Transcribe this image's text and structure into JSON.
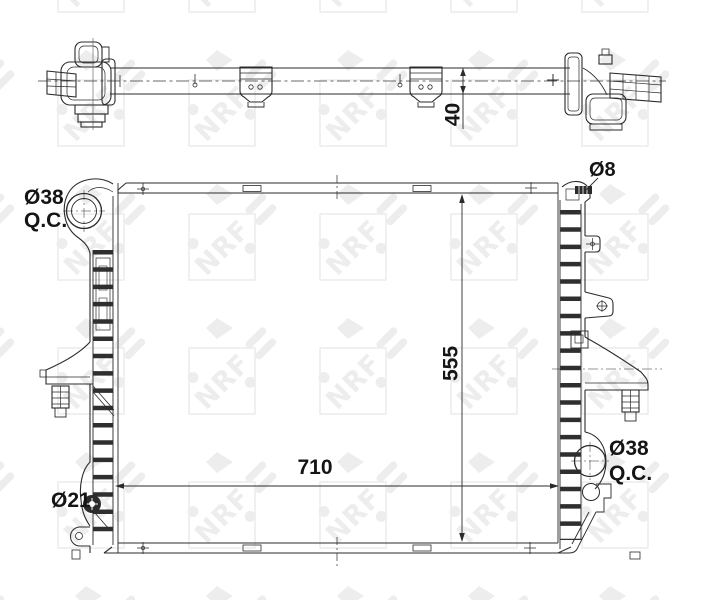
{
  "watermark": {
    "text": "NRF",
    "color": "#ededed"
  },
  "line_color": "#2b2b2b",
  "top_view": {
    "thickness_dimension": "40"
  },
  "front_view": {
    "width_dimension": "710",
    "height_dimension": "555",
    "ports": {
      "top_left": {
        "line1": "Ø38",
        "line2": "Q.C."
      },
      "top_right": {
        "label": "Ø8"
      },
      "bottom_left": {
        "label": "Ø21"
      },
      "bottom_right": {
        "line1": "Ø38",
        "line2": "Q.C."
      }
    }
  }
}
